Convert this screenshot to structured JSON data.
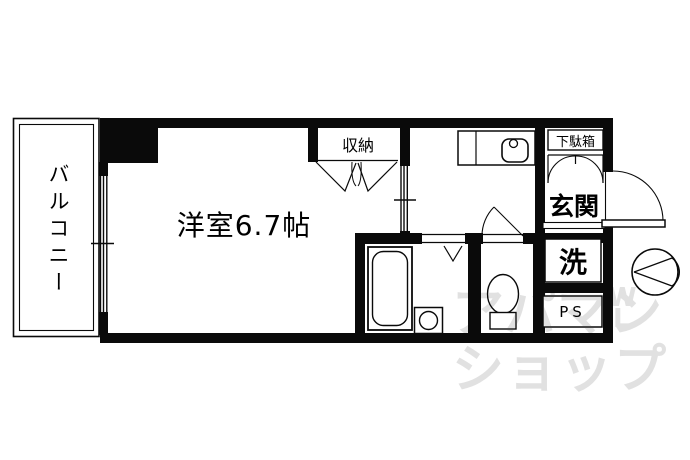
{
  "labels": {
    "balcony": "バルコニー",
    "main_room": "洋室6.7帖",
    "closet": "収納",
    "shoe_cabinet": "下駄箱",
    "entrance": "玄関",
    "laundry": "洗",
    "pipe_space": "PS"
  },
  "watermark": {
    "line1": "アパマン",
    "line2": "ショップ",
    "fragment1": "W",
    "fragment2": "L"
  },
  "colors": {
    "wall": "#0a0a0a",
    "background": "#ffffff",
    "watermark": "#e1e1e1"
  }
}
